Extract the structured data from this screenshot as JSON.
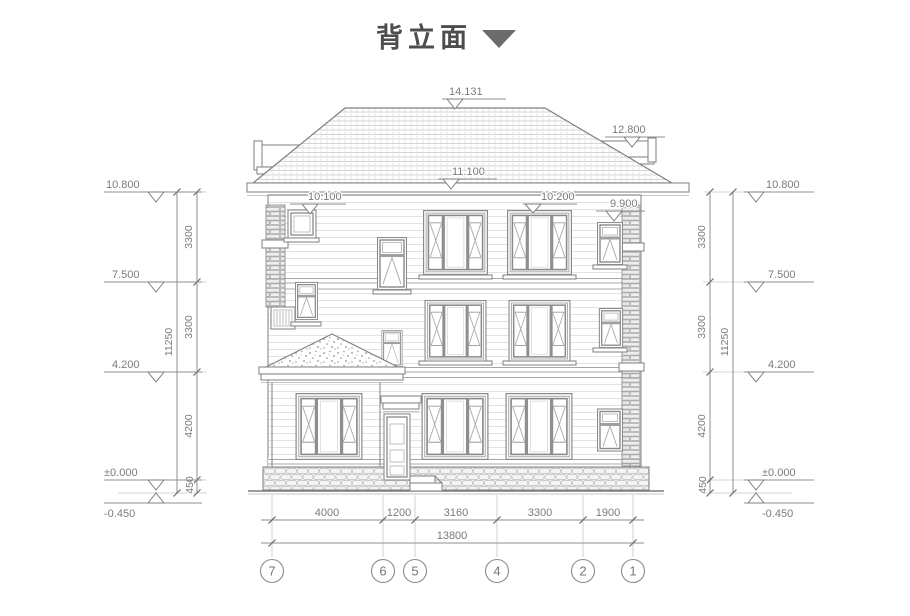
{
  "title": {
    "text": "背立面"
  },
  "markers": {
    "ridge": "14.131",
    "roof_right": "12.800",
    "eave": "11.100",
    "head_left": "10.100",
    "head_center": "10.200",
    "head_right": "9.900",
    "levels": [
      "10.800",
      "7.500",
      "4.200",
      "±0.000",
      "-0.450"
    ]
  },
  "dims": {
    "v_segments": [
      "3300",
      "3300",
      "4200",
      "450"
    ],
    "v_total": "11250",
    "h_segments": [
      "4000",
      "1200",
      "3160",
      "3300",
      "1900"
    ],
    "h_total": "13800"
  },
  "grid": {
    "labels": [
      "7",
      "6",
      "5",
      "4",
      "2",
      "1"
    ]
  }
}
